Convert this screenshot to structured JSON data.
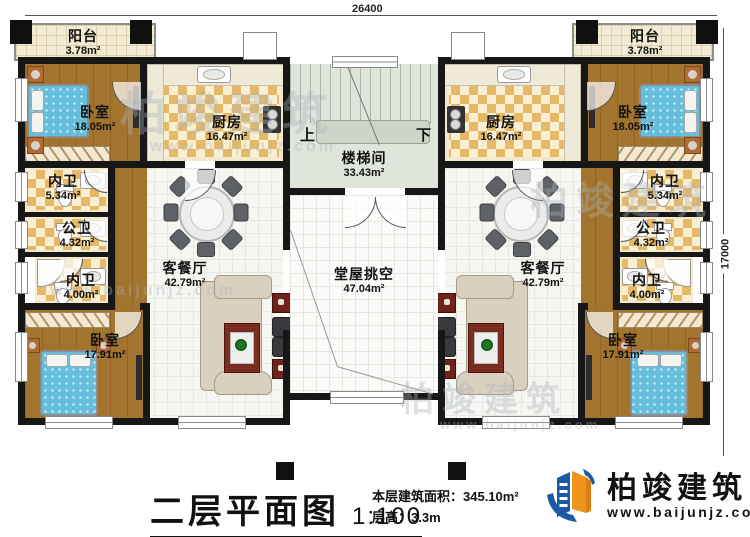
{
  "dimensions": {
    "top": "26400",
    "right": "17000"
  },
  "stairs": {
    "up": "上",
    "down": "下"
  },
  "rooms": {
    "balcony_l": {
      "name": "阳台",
      "area": "3.78m²"
    },
    "balcony_r": {
      "name": "阳台",
      "area": "3.78m²"
    },
    "bedroom_tl": {
      "name": "卧室",
      "area": "18.05m²"
    },
    "bedroom_tr": {
      "name": "卧室",
      "area": "18.05m²"
    },
    "kitchen_l": {
      "name": "厨房",
      "area": "16.47m²"
    },
    "kitchen_r": {
      "name": "厨房",
      "area": "16.47m²"
    },
    "stairwell": {
      "name": "楼梯间",
      "area": "33.43m²"
    },
    "hall_void": {
      "name": "堂屋挑空",
      "area": "47.04m²"
    },
    "bath5_l": {
      "name": "内卫",
      "area": "5.34m²"
    },
    "bath5_r": {
      "name": "内卫",
      "area": "5.34m²"
    },
    "pub_l": {
      "name": "公卫",
      "area": "4.32m²"
    },
    "pub_r": {
      "name": "公卫",
      "area": "4.32m²"
    },
    "bath4_l": {
      "name": "内卫",
      "area": "4.00m²"
    },
    "bath4_r": {
      "name": "内卫",
      "area": "4.00m²"
    },
    "bedroom_bl": {
      "name": "卧室",
      "area": "17.91m²"
    },
    "bedroom_br": {
      "name": "卧室",
      "area": "17.91m²"
    },
    "living_l": {
      "name": "客餐厅",
      "area": "42.79m²"
    },
    "living_r": {
      "name": "客餐厅",
      "area": "42.79m²"
    }
  },
  "title_block": {
    "title": "二层平面图",
    "scale": "1:100",
    "area_line": "本层建筑面积：345.10m²",
    "height_line": "层高：3.3m"
  },
  "logo": {
    "name": "柏竣建筑",
    "site": "www.baijunjz.com"
  },
  "watermark": {
    "text": "柏竣建筑",
    "site": "www.baijunjz.com"
  },
  "colors": {
    "wall": "#171717",
    "wood": "#a3742e",
    "checker": "#e5b968",
    "bed": "#65bedb",
    "logo_blue": "#1c5aa5",
    "logo_orange": "#f0931d"
  }
}
